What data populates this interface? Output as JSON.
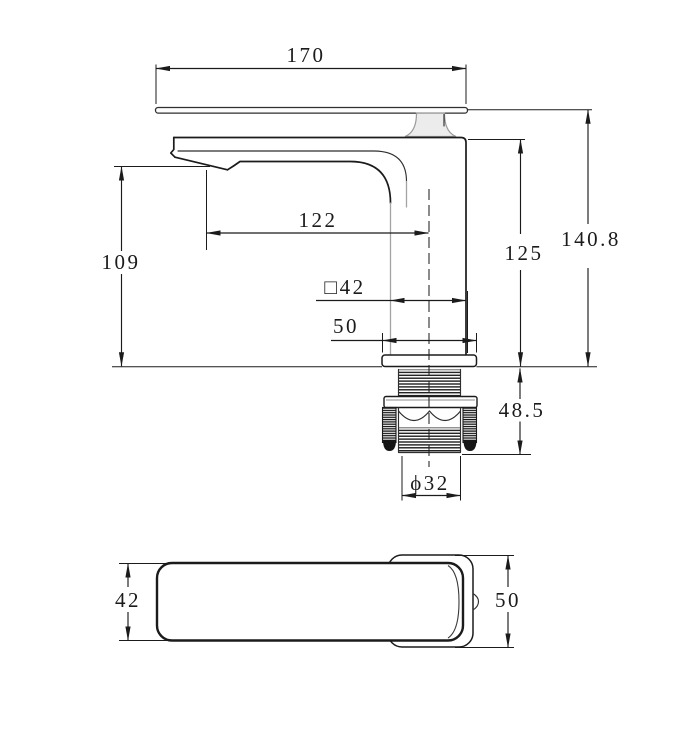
{
  "figure": {
    "background": "#ffffff",
    "line_color": "#1b1b1b",
    "gray_line_color": "#a3a3a3"
  },
  "side_view": {
    "overall_width": "170",
    "spout_reach": "122",
    "spout_height": "109",
    "body_square": "□42",
    "base_width": "50",
    "height_to_body_top": "125",
    "overall_height": "140.8",
    "under_counter_depth": "48.5",
    "shank_diameter": "ϕ32"
  },
  "top_view": {
    "handle_width": "42",
    "body_width": "50"
  }
}
